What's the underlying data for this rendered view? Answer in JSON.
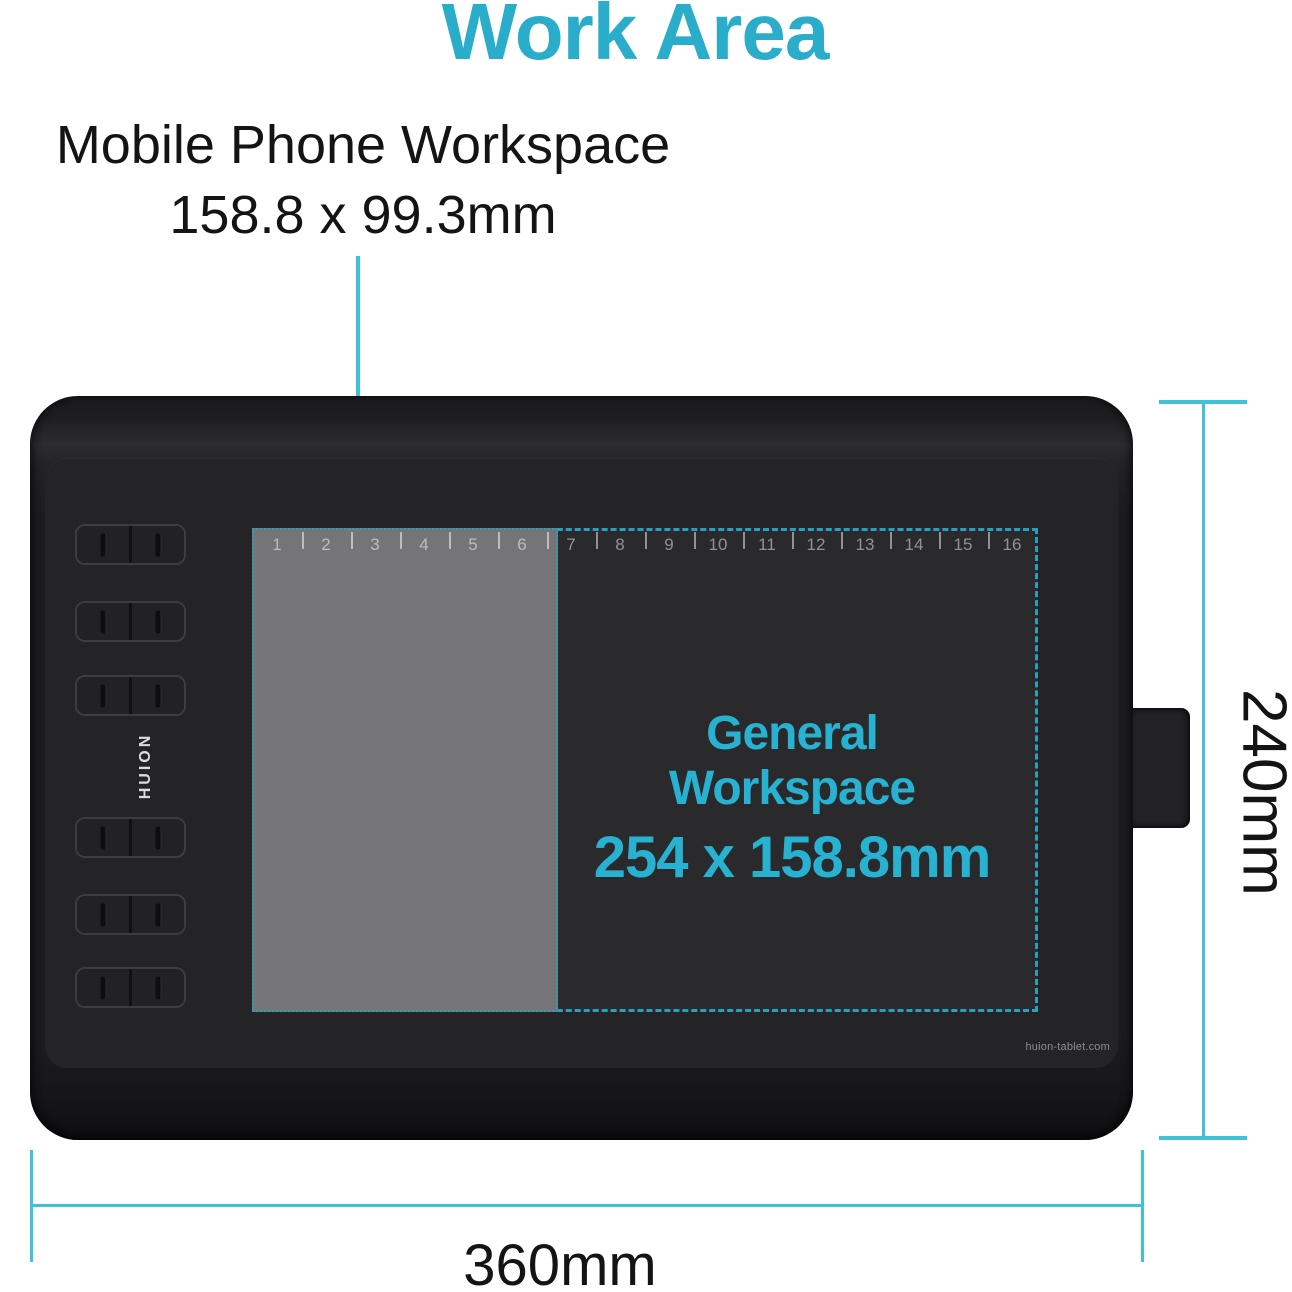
{
  "title": "Work Area",
  "colors": {
    "accent": "#29adca",
    "dash": "#2a9fbd",
    "dimension_line": "#3fc2d9",
    "general_text": "#28b2d2"
  },
  "callout": {
    "line1": "Mobile Phone Workspace",
    "line2": "158.8 x 99.3mm"
  },
  "tablet": {
    "brand": "HUION",
    "website": "huion-tablet.com",
    "express_key_pairs": 6,
    "ruler_numbers": [
      "1",
      "2",
      "3",
      "4",
      "5",
      "6",
      "7",
      "8",
      "9",
      "10",
      "11",
      "12",
      "13",
      "14",
      "15",
      "16"
    ],
    "general_workspace": {
      "label": "General Workspace",
      "size": "254 x 158.8mm"
    }
  },
  "dimension_labels": {
    "height": "240mm",
    "width": "360mm"
  }
}
